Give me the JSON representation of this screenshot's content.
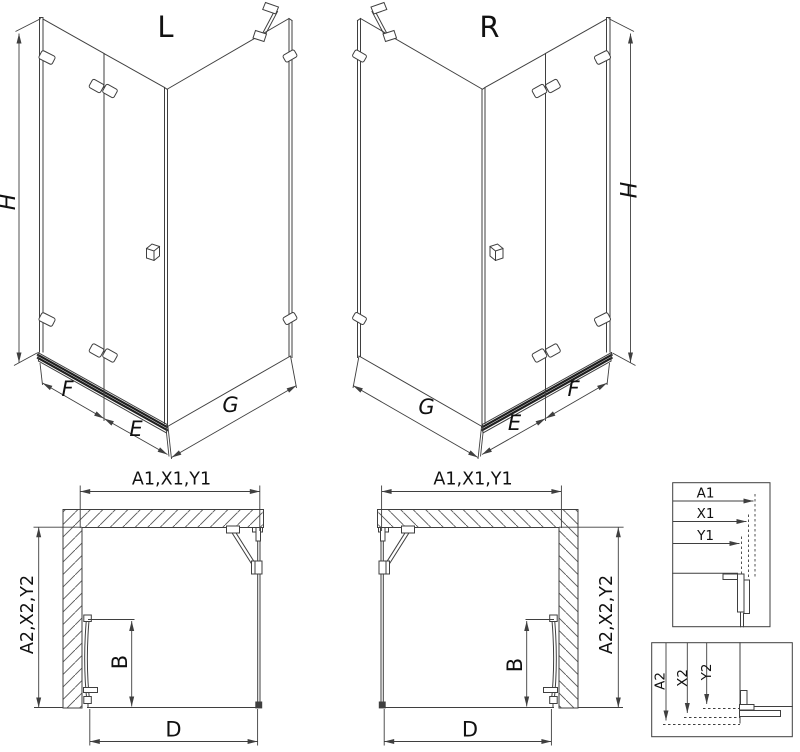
{
  "document": {
    "type": "shower-enclosure-installation-diagram",
    "background": "#ffffff"
  },
  "colors": {
    "line": "#3f3f3f",
    "line_dark": "#1f1f1f",
    "text": "#111111"
  },
  "views": {
    "iso_left": {
      "variant": "L",
      "height": "H",
      "front_fixed": "F",
      "door": "E",
      "side": "G"
    },
    "iso_right": {
      "variant": "R",
      "height": "H",
      "front_fixed": "F",
      "door": "E",
      "side": "G"
    },
    "plan_left": {
      "width": "A1,X1,Y1",
      "depth": "A2,X2,Y2",
      "door_width": "B",
      "opening": "D"
    },
    "plan_right": {
      "width": "A1,X1,Y1",
      "depth": "A2,X2,Y2",
      "door_width": "B",
      "opening": "D"
    },
    "detail_width": {
      "labels": [
        "A1",
        "X1",
        "Y1"
      ]
    },
    "detail_depth": {
      "labels": [
        "A2",
        "X2",
        "Y2"
      ]
    }
  }
}
